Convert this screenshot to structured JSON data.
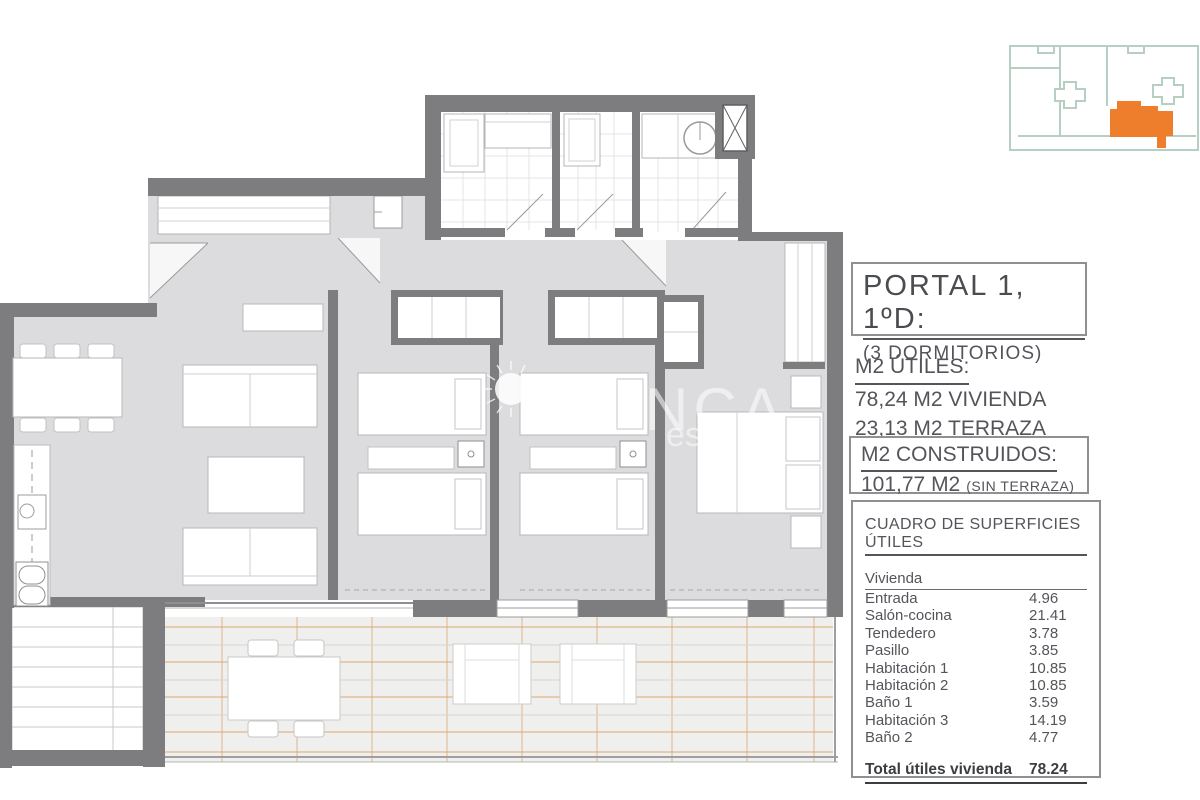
{
  "panel": {
    "portal_box": {
      "title": "PORTAL 1, 1ºD:",
      "subtitle": "(3 DORMITORIOS)"
    },
    "utiles": {
      "heading": "M2 ÚTILES:",
      "line1": "78,24 M2 VIVIENDA",
      "line2": "23,13 M2 TERRAZA"
    },
    "construidos": {
      "heading": "M2 CONSTRUIDOS:",
      "value": "101,77 M2",
      "note": "(SIN TERRAZA)"
    },
    "table": {
      "title": "CUADRO DE SUPERFICIES ÚTILES",
      "group": "Vivienda",
      "rows": [
        {
          "label": "Entrada",
          "value": "4.96"
        },
        {
          "label": "Salón-cocina",
          "value": "21.41"
        },
        {
          "label": "Tendedero",
          "value": "3.78"
        },
        {
          "label": "Pasillo",
          "value": "3.85"
        },
        {
          "label": "Habitación 1",
          "value": "10.85"
        },
        {
          "label": "Habitación 2",
          "value": "10.85"
        },
        {
          "label": "Baño 1",
          "value": "3.59"
        },
        {
          "label": "Habitación 3",
          "value": "14.19"
        },
        {
          "label": "Baño 2",
          "value": "4.77"
        }
      ],
      "total_label": "Total útiles vivienda",
      "total_value": "78.24"
    }
  },
  "watermark": {
    "fragment1": "NCA",
    "fragment2": "est"
  },
  "colors": {
    "unit_highlight_orange": "#ee7d2c",
    "keyplan_outline_green": "#b7cec2",
    "wall_gray": "#7d7d7f",
    "floor_gray": "#dcdcde",
    "terrace_line_orange": "#dcaa72"
  }
}
